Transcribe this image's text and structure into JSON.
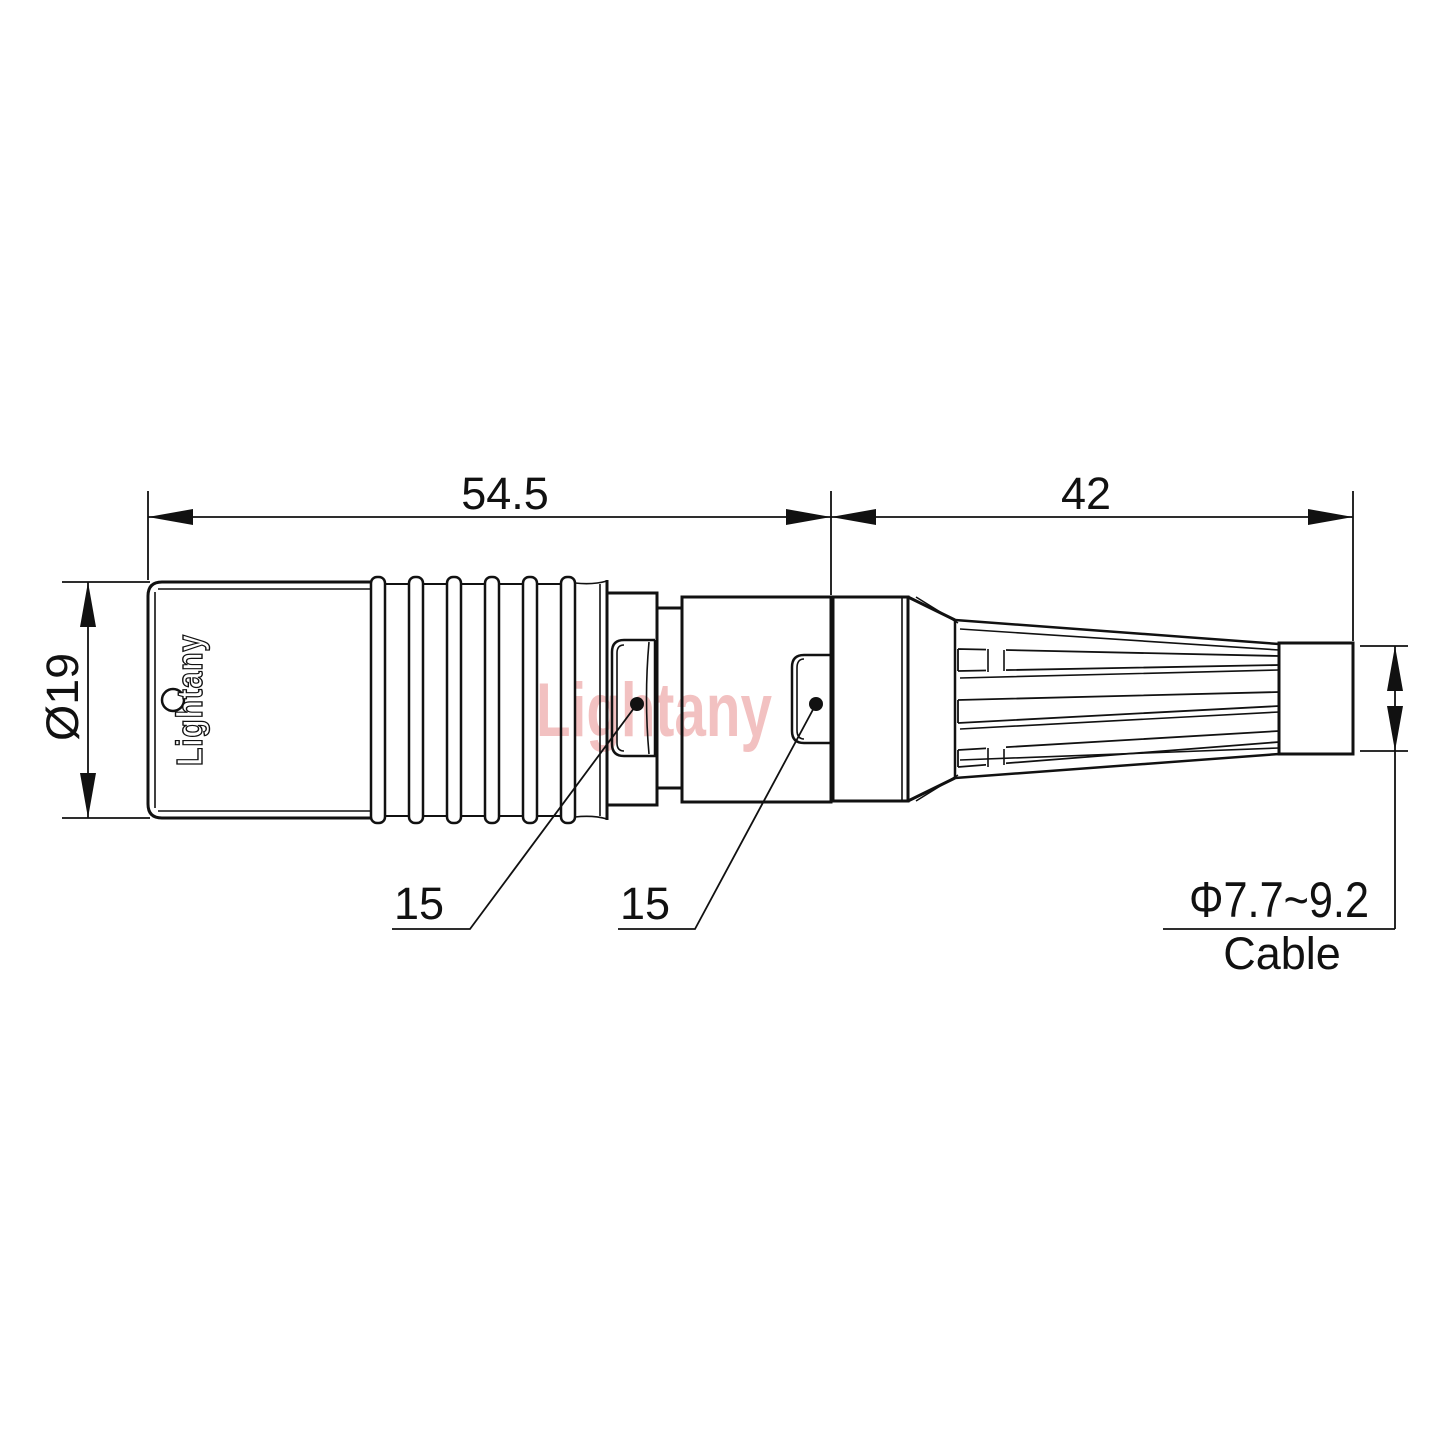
{
  "style": {
    "background": "#ffffff",
    "line_color": "#111111",
    "watermark_color": "#e98f8f"
  },
  "watermark": {
    "text": "Lightany"
  },
  "connector": {
    "engraving": "Lightany"
  },
  "dimensions": {
    "rear_length": "54.5",
    "front_length": "42",
    "body_diameter": "Ø19",
    "rear_latch": "15",
    "front_latch": "15",
    "cable_diameter": "Φ7.7~9.2",
    "cable_caption": "Cable"
  }
}
